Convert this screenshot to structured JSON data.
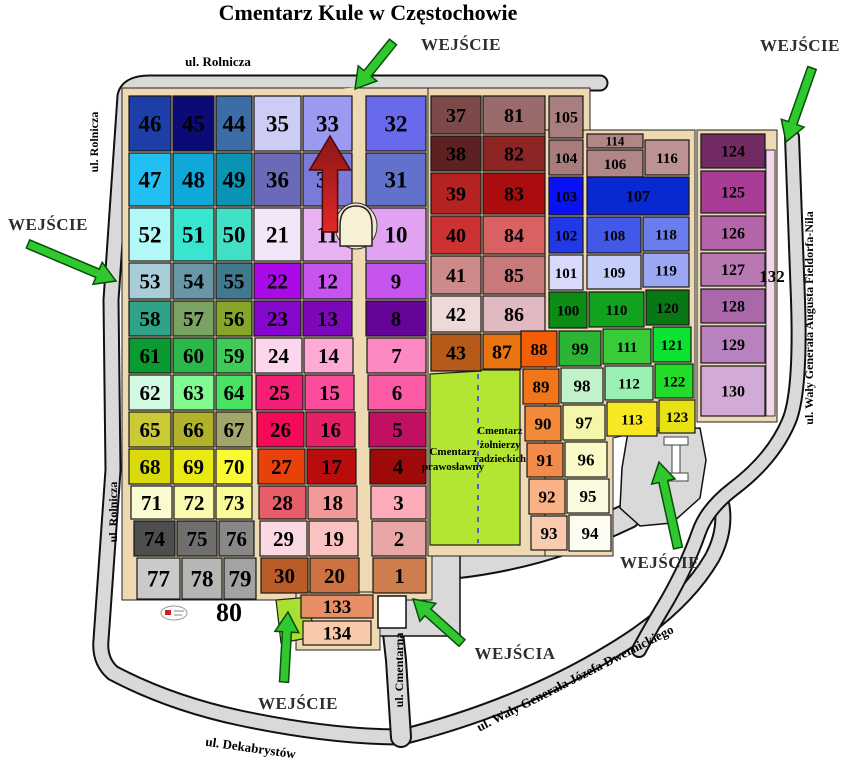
{
  "title": "Cmentarz Kule w Częstochowie",
  "colors": {
    "road": "#d9d9d9",
    "road_outline": "#111111",
    "base_path": "#eed9b2",
    "alley": "#eedcb2",
    "memorial_green": "#b2e632",
    "entrance_lawn": "#aade32",
    "arrow_green": "#2fc82f",
    "arrow_red_top": "#8c1616",
    "arrow_red_bottom": "#e02828",
    "chapel": "#f8f0d4",
    "plot_border": "#161616"
  },
  "plots": [
    [
      "46",
      128,
      95,
      44,
      57,
      "#1d3ea6",
      23
    ],
    [
      "45",
      172,
      95,
      43,
      57,
      "#0b0b77",
      23
    ],
    [
      "44",
      215,
      95,
      38,
      57,
      "#3d6da6",
      23
    ],
    [
      "35",
      253,
      95,
      49,
      57,
      "#ccccf5",
      23
    ],
    [
      "33",
      302,
      95,
      51,
      57,
      "#9a9af0",
      23
    ],
    [
      "32",
      365,
      95,
      62,
      57,
      "#6969ec",
      23
    ],
    [
      "37",
      430,
      95,
      52,
      40,
      "#7d4a4a",
      20
    ],
    [
      "81",
      482,
      95,
      64,
      40,
      "#9a6b6b",
      20
    ],
    [
      "105",
      548,
      95,
      36,
      44,
      "#a87e7e",
      16
    ],
    [
      "47",
      128,
      152,
      44,
      55,
      "#22bff2",
      23
    ],
    [
      "48",
      172,
      152,
      43,
      55,
      "#10a8d8",
      23
    ],
    [
      "49",
      215,
      152,
      38,
      55,
      "#0894b2",
      23
    ],
    [
      "36",
      253,
      152,
      49,
      55,
      "#6a6ab8",
      23
    ],
    [
      "34",
      302,
      152,
      51,
      55,
      "#7a7ad8",
      23
    ],
    [
      "31",
      365,
      152,
      62,
      55,
      "#6272cc",
      23
    ],
    [
      "38",
      430,
      135,
      52,
      37,
      "#5d2121",
      20
    ],
    [
      "82",
      482,
      135,
      64,
      37,
      "#8d2525",
      20
    ],
    [
      "104",
      548,
      139,
      36,
      37,
      "#a87c7c",
      15
    ],
    [
      "114",
      586,
      133,
      58,
      16,
      "#b08686",
      13
    ],
    [
      "106",
      586,
      149,
      58,
      29,
      "#b08686",
      15
    ],
    [
      "116",
      644,
      139,
      46,
      37,
      "#bd9292",
      15
    ],
    [
      "52",
      128,
      207,
      44,
      55,
      "#b2f8f8",
      23
    ],
    [
      "51",
      172,
      207,
      43,
      55,
      "#39e5cf",
      23
    ],
    [
      "50",
      215,
      207,
      38,
      55,
      "#42dfc7",
      23
    ],
    [
      "21",
      253,
      207,
      49,
      55,
      "#f2e6f8",
      23
    ],
    [
      "11",
      302,
      207,
      51,
      55,
      "#e9b2f2",
      23
    ],
    [
      "10",
      365,
      207,
      62,
      55,
      "#e2a2f2",
      23
    ],
    [
      "39",
      430,
      172,
      52,
      43,
      "#b52222",
      20
    ],
    [
      "83",
      482,
      172,
      64,
      43,
      "#a90d0d",
      20
    ],
    [
      "103",
      548,
      176,
      36,
      40,
      "#0a12f5",
      15
    ],
    [
      "107",
      586,
      176,
      104,
      40,
      "#0a28cf",
      16
    ],
    [
      "53",
      128,
      262,
      44,
      38,
      "#a8cdd8",
      21
    ],
    [
      "54",
      172,
      262,
      43,
      38,
      "#6897a8",
      21
    ],
    [
      "55",
      215,
      262,
      38,
      38,
      "#417a8e",
      21
    ],
    [
      "22",
      253,
      262,
      49,
      38,
      "#aa0ae8",
      21
    ],
    [
      "12",
      302,
      262,
      51,
      38,
      "#c854f0",
      21
    ],
    [
      "9",
      365,
      262,
      62,
      38,
      "#c554ee",
      21
    ],
    [
      "40",
      430,
      215,
      52,
      40,
      "#cd3232",
      20
    ],
    [
      "84",
      482,
      215,
      64,
      40,
      "#d86262",
      20
    ],
    [
      "102",
      548,
      216,
      36,
      38,
      "#2038e8",
      15
    ],
    [
      "108",
      586,
      216,
      56,
      38,
      "#4259e8",
      15
    ],
    [
      "118",
      642,
      216,
      48,
      36,
      "#6b7dec",
      15
    ],
    [
      "58",
      128,
      300,
      44,
      37,
      "#2fa287",
      21
    ],
    [
      "57",
      172,
      300,
      43,
      37,
      "#7aa262",
      21
    ],
    [
      "56",
      215,
      300,
      38,
      37,
      "#86a62a",
      21
    ],
    [
      "23",
      253,
      300,
      49,
      37,
      "#8608cc",
      21
    ],
    [
      "13",
      302,
      300,
      51,
      37,
      "#7c08ba",
      21
    ],
    [
      "8",
      365,
      300,
      62,
      37,
      "#660499",
      21
    ],
    [
      "41",
      430,
      255,
      52,
      40,
      "#cd8a8a",
      20
    ],
    [
      "85",
      482,
      255,
      64,
      40,
      "#c87a7a",
      20
    ],
    [
      "101",
      548,
      254,
      36,
      37,
      "#d9d9fc",
      15
    ],
    [
      "109",
      586,
      254,
      56,
      36,
      "#c5cef8",
      15
    ],
    [
      "119",
      642,
      252,
      48,
      36,
      "#9ba7f2",
      15
    ],
    [
      "61",
      128,
      337,
      44,
      37,
      "#0a9a32",
      21
    ],
    [
      "60",
      172,
      337,
      43,
      37,
      "#2ab84a",
      21
    ],
    [
      "59",
      215,
      337,
      38,
      37,
      "#3fca59",
      21
    ],
    [
      "24",
      254,
      337,
      49,
      37,
      "#fbd6ec",
      21
    ],
    [
      "14",
      303,
      337,
      51,
      37,
      "#fdaad6",
      21
    ],
    [
      "7",
      366,
      337,
      61,
      37,
      "#fc89c2",
      21
    ],
    [
      "42",
      430,
      295,
      52,
      38,
      "#eed9d9",
      20
    ],
    [
      "86",
      482,
      295,
      64,
      38,
      "#e1b9c1",
      20
    ],
    [
      "100",
      548,
      291,
      40,
      38,
      "#0a8c15",
      15
    ],
    [
      "110",
      588,
      291,
      57,
      37,
      "#12a21d",
      15
    ],
    [
      "120",
      645,
      289,
      45,
      37,
      "#087815",
      15
    ],
    [
      "62",
      128,
      374,
      44,
      37,
      "#d2fae2",
      21
    ],
    [
      "63",
      172,
      374,
      43,
      37,
      "#82fa92",
      21
    ],
    [
      "64",
      215,
      374,
      38,
      37,
      "#4ae262",
      21
    ],
    [
      "25",
      255,
      374,
      49,
      37,
      "#f42078",
      21
    ],
    [
      "15",
      304,
      374,
      51,
      37,
      "#fc4c9c",
      21
    ],
    [
      "6",
      367,
      374,
      60,
      37,
      "#fc5aa4",
      21
    ],
    [
      "43",
      430,
      333,
      52,
      39,
      "#b65a1a",
      20
    ],
    [
      "87",
      482,
      333,
      40,
      37,
      "#e87412",
      20
    ],
    [
      "88",
      520,
      330,
      38,
      38,
      "#f25e08",
      17
    ],
    [
      "99",
      558,
      330,
      44,
      37,
      "#2cb434",
      17
    ],
    [
      "111",
      602,
      328,
      50,
      37,
      "#38cc38",
      15
    ],
    [
      "121",
      652,
      326,
      40,
      37,
      "#0ce232",
      15
    ],
    [
      "65",
      128,
      411,
      44,
      37,
      "#caca36",
      21
    ],
    [
      "66",
      172,
      411,
      43,
      37,
      "#b2b22a",
      21
    ],
    [
      "67",
      215,
      411,
      38,
      37,
      "#a2a66a",
      21
    ],
    [
      "26",
      256,
      411,
      49,
      37,
      "#f50a5a",
      21
    ],
    [
      "16",
      305,
      411,
      51,
      37,
      "#e62066",
      21
    ],
    [
      "5",
      368,
      411,
      59,
      37,
      "#c11062",
      21
    ],
    [
      "89",
      522,
      368,
      38,
      37,
      "#f07619",
      17
    ],
    [
      "98",
      560,
      367,
      44,
      37,
      "#c2f2ca",
      17
    ],
    [
      "112",
      604,
      365,
      50,
      36,
      "#9af0b2",
      15
    ],
    [
      "122",
      654,
      363,
      40,
      36,
      "#22dc2a",
      15
    ],
    [
      "68",
      128,
      448,
      44,
      37,
      "#dada0a",
      21
    ],
    [
      "69",
      172,
      448,
      43,
      37,
      "#eaea12",
      21
    ],
    [
      "70",
      215,
      448,
      38,
      37,
      "#fafa32",
      21
    ],
    [
      "27",
      257,
      448,
      49,
      37,
      "#e8420a",
      21
    ],
    [
      "17",
      306,
      448,
      51,
      37,
      "#ba0c0c",
      21
    ],
    [
      "4",
      369,
      448,
      58,
      37,
      "#9e0a0a",
      21
    ],
    [
      "90",
      524,
      405,
      38,
      37,
      "#f28a3a",
      17
    ],
    [
      "97",
      562,
      404,
      44,
      37,
      "#f6f6aa",
      17
    ],
    [
      "113",
      606,
      401,
      52,
      36,
      "#f8e822",
      15
    ],
    [
      "123",
      658,
      399,
      38,
      35,
      "#e8e214",
      15
    ],
    [
      "71",
      130,
      485,
      43,
      35,
      "#fbfbd2",
      21
    ],
    [
      "72",
      173,
      485,
      42,
      35,
      "#fafaae",
      21
    ],
    [
      "73",
      215,
      485,
      38,
      35,
      "#fafa98",
      21
    ],
    [
      "28",
      258,
      485,
      49,
      35,
      "#e65e68",
      21
    ],
    [
      "18",
      307,
      485,
      51,
      35,
      "#f29a9a",
      21
    ],
    [
      "3",
      370,
      485,
      57,
      35,
      "#fcabb8",
      21
    ],
    [
      "91",
      526,
      442,
      38,
      36,
      "#f28a4a",
      17
    ],
    [
      "96",
      564,
      441,
      44,
      37,
      "#fafac6",
      17
    ],
    [
      "74",
      133,
      520,
      43,
      37,
      "#4e4e4e",
      21
    ],
    [
      "75",
      176,
      520,
      42,
      37,
      "#6f6f6f",
      21
    ],
    [
      "76",
      218,
      520,
      37,
      37,
      "#888888",
      21
    ],
    [
      "29",
      259,
      520,
      49,
      37,
      "#fbd9e2",
      21
    ],
    [
      "19",
      308,
      520,
      51,
      37,
      "#fbc2c2",
      21
    ],
    [
      "2",
      371,
      520,
      56,
      37,
      "#e8a6a6",
      21
    ],
    [
      "92",
      528,
      478,
      38,
      37,
      "#f8b286",
      17
    ],
    [
      "95",
      566,
      478,
      44,
      36,
      "#fafade",
      17
    ],
    [
      "77",
      136,
      557,
      45,
      43,
      "#cacaca",
      23
    ],
    [
      "78",
      181,
      557,
      42,
      43,
      "#b6b6b6",
      23
    ],
    [
      "79",
      223,
      557,
      34,
      43,
      "#a3a3a3",
      23
    ],
    [
      "30",
      260,
      557,
      49,
      37,
      "#ba5c28",
      21
    ],
    [
      "20",
      309,
      557,
      51,
      37,
      "#cd7242",
      21
    ],
    [
      "1",
      372,
      557,
      55,
      37,
      "#cd7e4c",
      21
    ],
    [
      "93",
      530,
      515,
      38,
      36,
      "#f8caae",
      17
    ],
    [
      "94",
      568,
      514,
      44,
      38,
      "#fcfcf0",
      17
    ],
    [
      "124",
      700,
      133,
      66,
      36,
      "#722a62",
      16
    ],
    [
      "125",
      700,
      170,
      66,
      44,
      "#a93d96",
      16
    ],
    [
      "126",
      700,
      215,
      66,
      36,
      "#b464a8",
      16
    ],
    [
      "127",
      700,
      252,
      66,
      35,
      "#b878b2",
      16
    ],
    [
      "128",
      700,
      288,
      66,
      36,
      "#aa68aa",
      16
    ],
    [
      "129",
      700,
      325,
      66,
      39,
      "#b882be",
      16
    ],
    [
      "130",
      700,
      365,
      66,
      52,
      "#d2aad6",
      16
    ],
    [
      "133",
      300,
      594,
      74,
      25,
      "#e88e66",
      19
    ],
    [
      "134",
      302,
      620,
      70,
      26,
      "#f8caaa",
      19
    ]
  ],
  "street_labels": [
    {
      "text": "ul. Rolnicza",
      "x": 218,
      "y": 66,
      "rotate": 0,
      "size": 13
    },
    {
      "text": "ul. Rolnicza",
      "x": 98,
      "y": 142,
      "rotate": -90,
      "size": 12
    },
    {
      "text": "ul. Rolnicza",
      "x": 117,
      "y": 512,
      "rotate": -90,
      "size": 12
    },
    {
      "text": "ul. Wały Generała Augusta Fieldorfa-Nila",
      "x": 813,
      "y": 318,
      "rotate": -90,
      "size": 12
    },
    {
      "text": "ul. Cmentarna",
      "x": 403,
      "y": 670,
      "rotate": -90,
      "size": 12
    },
    {
      "text": "ul. Dekabrystów",
      "x": 250,
      "y": 752,
      "rotate": 8,
      "size": 13
    },
    {
      "text": "ul. Wały Generała Józefa Dwernickiego",
      "x": 577,
      "y": 682,
      "rotate": -27,
      "size": 13
    }
  ],
  "entrance_labels": [
    {
      "text": "WEJŚCIE",
      "x": 461,
      "y": 50
    },
    {
      "text": "WEJŚCIE",
      "x": 800,
      "y": 51
    },
    {
      "text": "WEJŚCIE",
      "x": 48,
      "y": 230
    },
    {
      "text": "WEJŚCIE",
      "x": 298,
      "y": 709
    },
    {
      "text": "WEJŚCIA",
      "x": 515,
      "y": 659
    },
    {
      "text": "WEJŚCIE",
      "x": 660,
      "y": 568
    }
  ],
  "area_labels": [
    {
      "lines": [
        "Cmentarz",
        "prawosławny"
      ],
      "x": 453,
      "y": 455,
      "size": 11,
      "lh": 15
    },
    {
      "lines": [
        "Cmentarz",
        "żołnierzy",
        "radzieckich"
      ],
      "x": 500,
      "y": 434,
      "size": 10.5,
      "lh": 14
    }
  ],
  "misc_labels": [
    {
      "text": "132",
      "x": 772,
      "y": 282,
      "size": 17
    },
    {
      "text": "80",
      "x": 229,
      "y": 621,
      "size": 26
    }
  ],
  "arrows": [
    {
      "name": "entrance-arrow-top",
      "x1": 393,
      "y1": 42,
      "x2": 355,
      "y2": 89,
      "color": "#2fc82f",
      "s": 1
    },
    {
      "name": "entrance-arrow-top-right",
      "x1": 812,
      "y1": 68,
      "x2": 786,
      "y2": 142,
      "color": "#2fc82f",
      "s": 1
    },
    {
      "name": "entrance-arrow-left",
      "x1": 28,
      "y1": 244,
      "x2": 116,
      "y2": 281,
      "color": "#2fc82f",
      "s": 1
    },
    {
      "name": "entrance-arrow-bottom",
      "x1": 284,
      "y1": 682,
      "x2": 288,
      "y2": 612,
      "color": "#2fc82f",
      "s": 1
    },
    {
      "name": "entrance-arrow-gates",
      "x1": 462,
      "y1": 643,
      "x2": 413,
      "y2": 599,
      "color": "#2fc82f",
      "s": 1
    },
    {
      "name": "entrance-arrow-right",
      "x1": 678,
      "y1": 548,
      "x2": 659,
      "y2": 462,
      "color": "#2fc82f",
      "s": 1
    },
    {
      "name": "main-alley-arrow",
      "x1": 330,
      "y1": 232,
      "x2": 330,
      "y2": 136,
      "color": "red-gradient",
      "s": 1.7
    }
  ]
}
